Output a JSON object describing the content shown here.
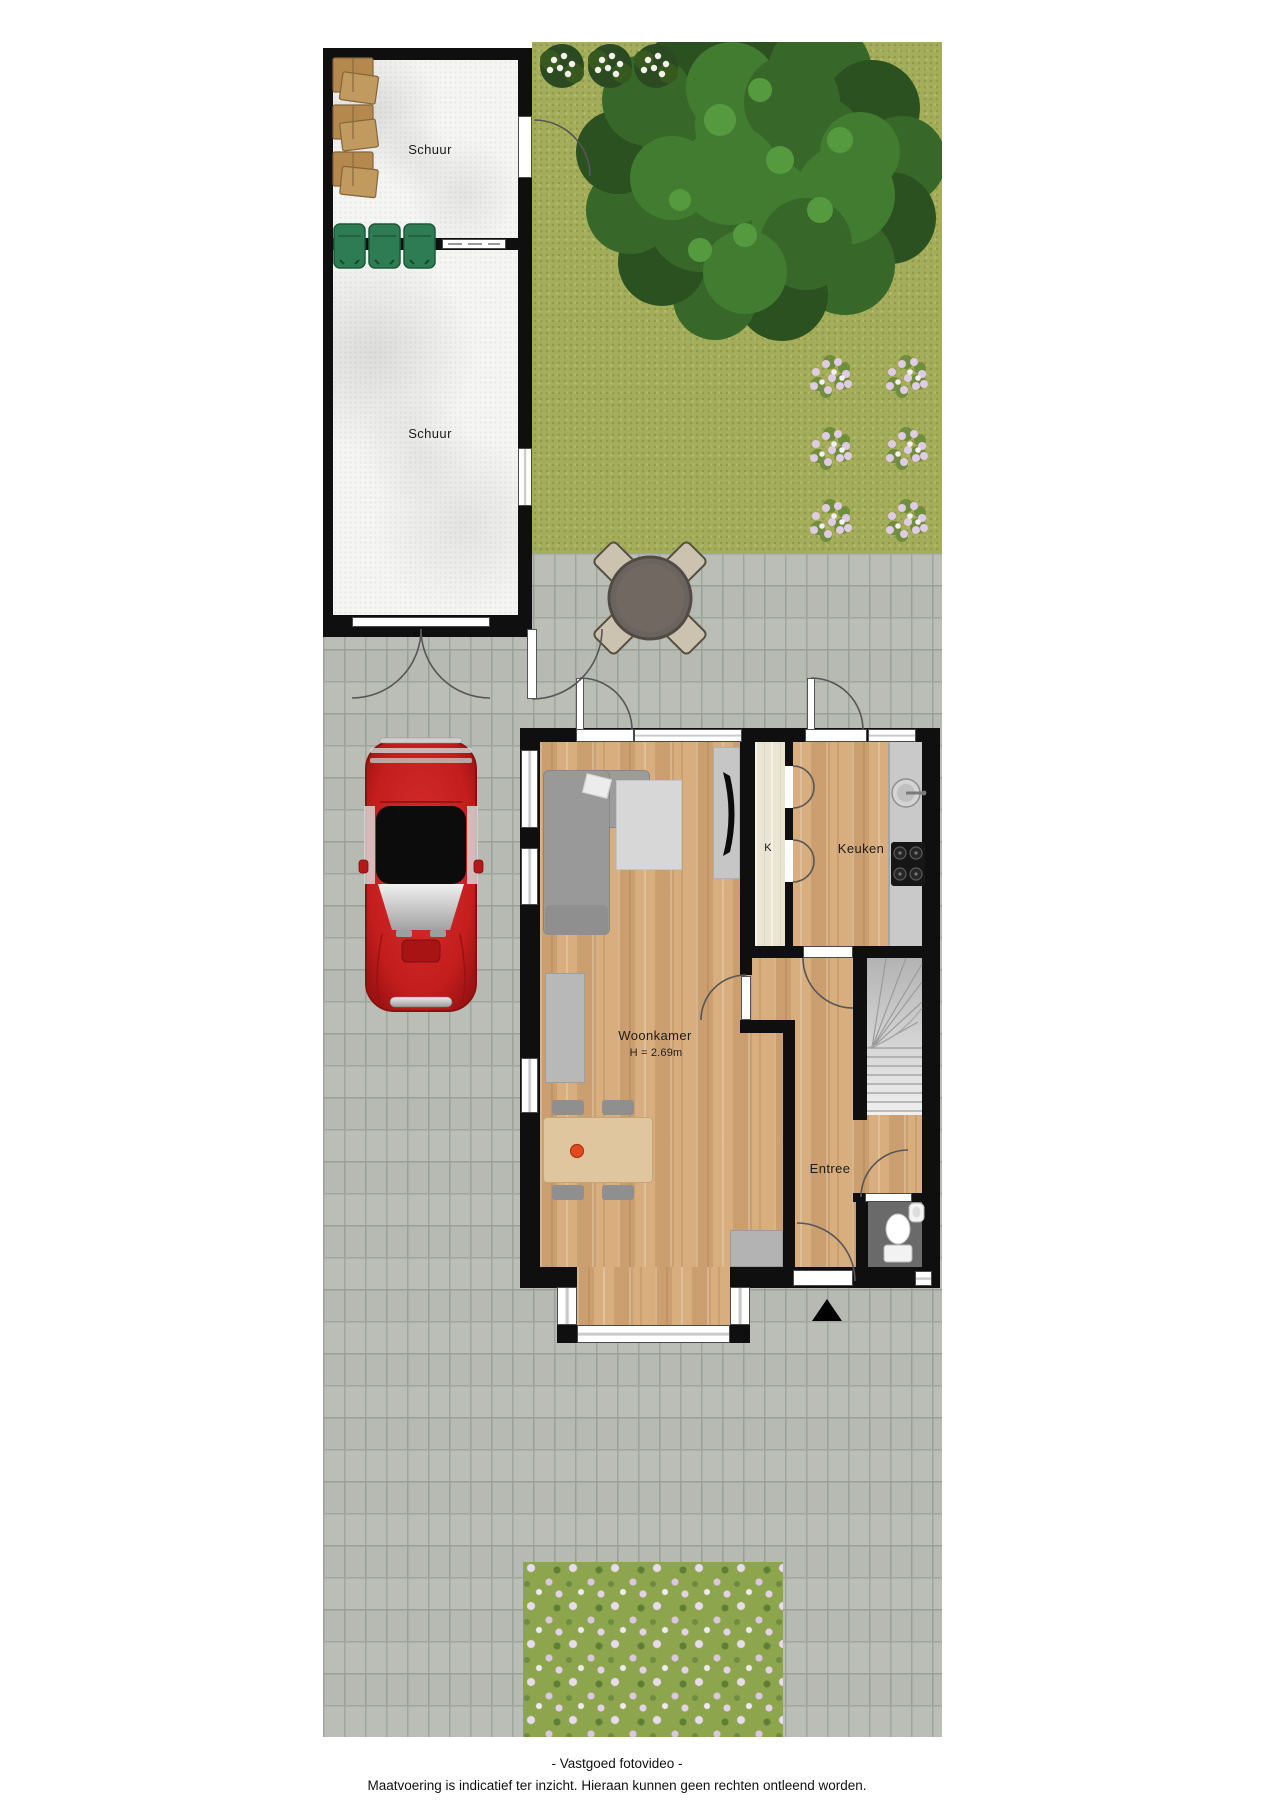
{
  "rooms": {
    "shed_top": {
      "label": "Schuur"
    },
    "shed_bottom": {
      "label": "Schuur"
    },
    "closet": {
      "label": "K"
    },
    "kitchen": {
      "label": "Keuken"
    },
    "living": {
      "label": "Woonkamer",
      "ceiling_height": "H = 2.69m"
    },
    "hall": {
      "label": "Entree"
    }
  },
  "footer": {
    "credit": "- Vastgoed fotovideo -",
    "disclaimer": "Maatvoering is indicatief ter inzicht. Hieraan kunnen geen rechten ontleend worden."
  },
  "colors": {
    "grass": "#a4ad5a",
    "paving": "#b6bab2",
    "wood_floor": "#d4a97b",
    "closet_floor": "#e9e5d2",
    "wall": "#0f0f0f",
    "car_red": "#c41d1d",
    "bins_green": "#2e7c54",
    "boxes_brown": "#b5894e",
    "bowl_accent": "#e14a1e"
  },
  "objects": [
    "tree",
    "white-flower-bushes",
    "pink-flower-bushes",
    "garden-table-set",
    "red-classic-car",
    "storage-boxes",
    "green-bins",
    "corner-sofa",
    "tv",
    "rug",
    "sideboard",
    "dining-table",
    "fruit-bowl",
    "kitchen-sink",
    "stove",
    "staircase",
    "toilet",
    "hand-basin",
    "flower-bed",
    "entrance-arrow"
  ]
}
